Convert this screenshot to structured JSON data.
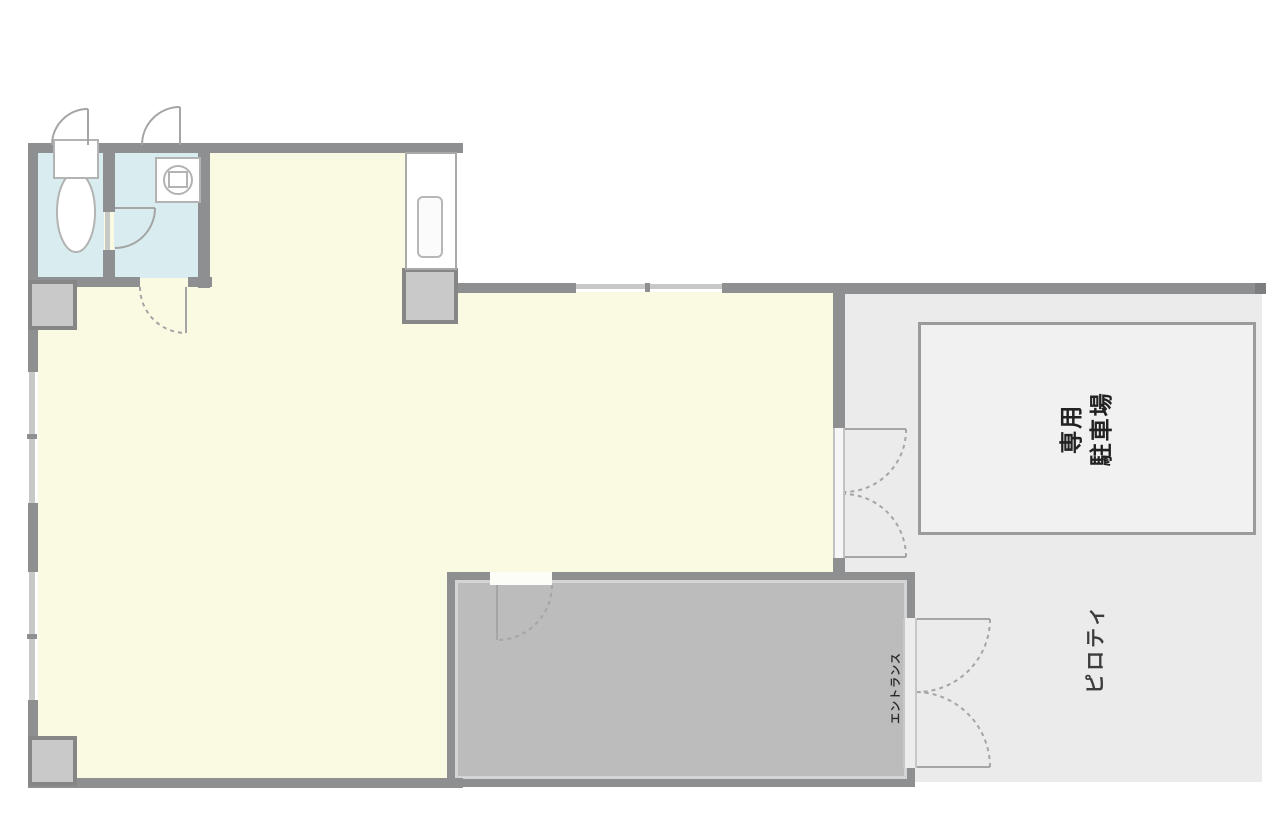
{
  "plan": {
    "parking_label_lines": [
      "専用",
      "駐車場"
    ],
    "piloti_label": "ピロティ",
    "entrance_label": "エントランス"
  },
  "colors": {
    "cream": "#fafae3",
    "blue": "#d9edf1",
    "wall": "#8e8f91",
    "wall_dark": "#7d7e80",
    "wall_light": "#c6c9c6",
    "grayroom": "#bcbcbc",
    "pillar_fill": "#c9c9c9",
    "pillar_border": "#868686",
    "piloti": "#ebebeb",
    "parking_fill": "#f1f1f1",
    "parking_border": "#9b9b9b",
    "door": "#a5a5a5",
    "fixture": "#b3b3b3",
    "text": "#222222"
  }
}
